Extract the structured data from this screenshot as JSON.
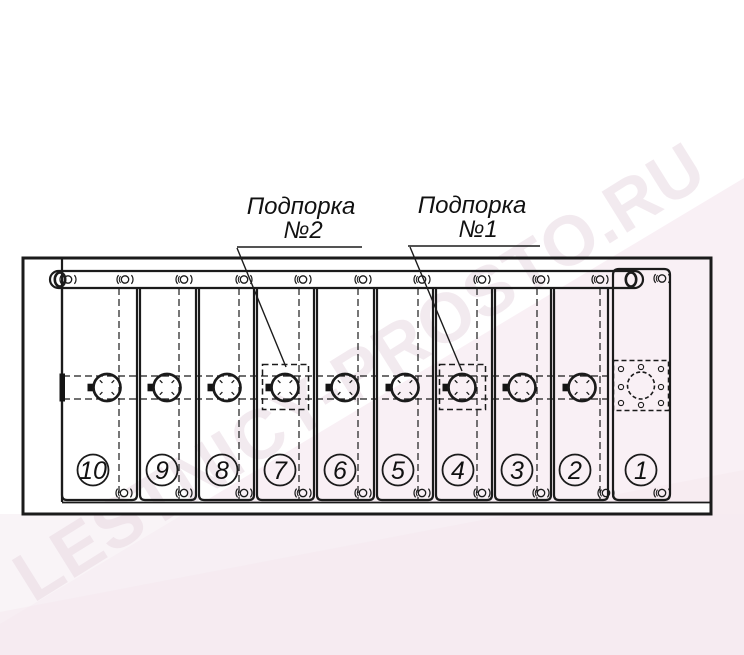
{
  "watermark": {
    "text": "LESTNICY-PROSTO.RU",
    "color": "#e9d9e3"
  },
  "annotations": {
    "support2": {
      "title": "Подпорка",
      "number": "№2"
    },
    "support1": {
      "title": "Подпорка",
      "number": "№1"
    }
  },
  "panels": [
    {
      "number": "10"
    },
    {
      "number": "9"
    },
    {
      "number": "8"
    },
    {
      "number": "7",
      "support": "№2"
    },
    {
      "number": "6"
    },
    {
      "number": "5"
    },
    {
      "number": "4",
      "support": "№1"
    },
    {
      "number": "3"
    },
    {
      "number": "2"
    },
    {
      "number": "1",
      "mount_plate": true
    }
  ],
  "colors": {
    "line": "#1b1b1b",
    "band": "#f8eef4",
    "bottom_strip": "#f6eef2",
    "watermark": "#e9d9e3"
  }
}
